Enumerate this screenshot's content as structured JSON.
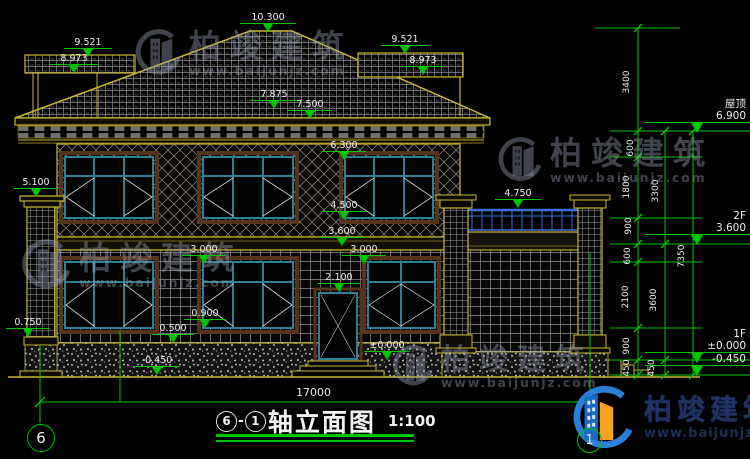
{
  "colors": {
    "dimension_green": "#00c400",
    "building_yellow": "#c8b832",
    "window_teal": "#2f7f95",
    "railing_blue": "#3c6fd8",
    "text_white": "#ededed",
    "watermark_gray": "#98a0b6",
    "logo_navy": "#1e3263",
    "logo_blue": "#2b7fd9",
    "logo_orange": "#f2a31f"
  },
  "levels": [
    {
      "name": "ridge",
      "value": "10.300"
    },
    {
      "name": "left-band-top",
      "value": "9.521"
    },
    {
      "name": "left-band-bottom",
      "value": "8.973"
    },
    {
      "name": "right-band-top",
      "value": "9.521"
    },
    {
      "name": "right-band-bottom",
      "value": "8.973"
    },
    {
      "name": "eave-top",
      "value": "7.875"
    },
    {
      "name": "eave-bottom",
      "value": "7.500"
    },
    {
      "name": "f2-window-head",
      "value": "6.300"
    },
    {
      "name": "porch-capital",
      "value": "5.100"
    },
    {
      "name": "annex-railing",
      "value": "4.750"
    },
    {
      "name": "f2-window-sill",
      "value": "4.500"
    },
    {
      "name": "f2-floor-band",
      "value": "3.600"
    },
    {
      "name": "f1-window-head-left",
      "value": "3.000"
    },
    {
      "name": "f1-window-head-right",
      "value": "3.000"
    },
    {
      "name": "door-head",
      "value": "2.100"
    },
    {
      "name": "f1-window-sill",
      "value": "0.900"
    },
    {
      "name": "plinth-top",
      "value": "0.500"
    },
    {
      "name": "porch-pedestal",
      "value": "0.750"
    },
    {
      "name": "ground",
      "value": "-0.450"
    },
    {
      "name": "entry-floor",
      "value": "±0.000"
    }
  ],
  "right_levels": {
    "roof": {
      "label": "屋顶",
      "value": "6.900"
    },
    "f2": {
      "label": "2F",
      "value": "3.600"
    },
    "f1": {
      "label": "1F",
      "value": "±0.000"
    },
    "ground": {
      "value": "-0.450"
    }
  },
  "dims": {
    "top": "3400",
    "chain1": [
      "600",
      "1800",
      "900",
      "600",
      "2100",
      "900",
      "450"
    ],
    "chain2": [
      "3300",
      "3600",
      "450"
    ],
    "overall": "7350",
    "total_width": "17000"
  },
  "axes": {
    "left": "6",
    "right": "1"
  },
  "title": {
    "axis_from": "6",
    "sep": "-",
    "axis_to": "1",
    "name": "轴立面图",
    "scale": "1:100"
  },
  "watermark": {
    "brand": "柏竣建筑",
    "url": "www.baijunjz.com"
  }
}
